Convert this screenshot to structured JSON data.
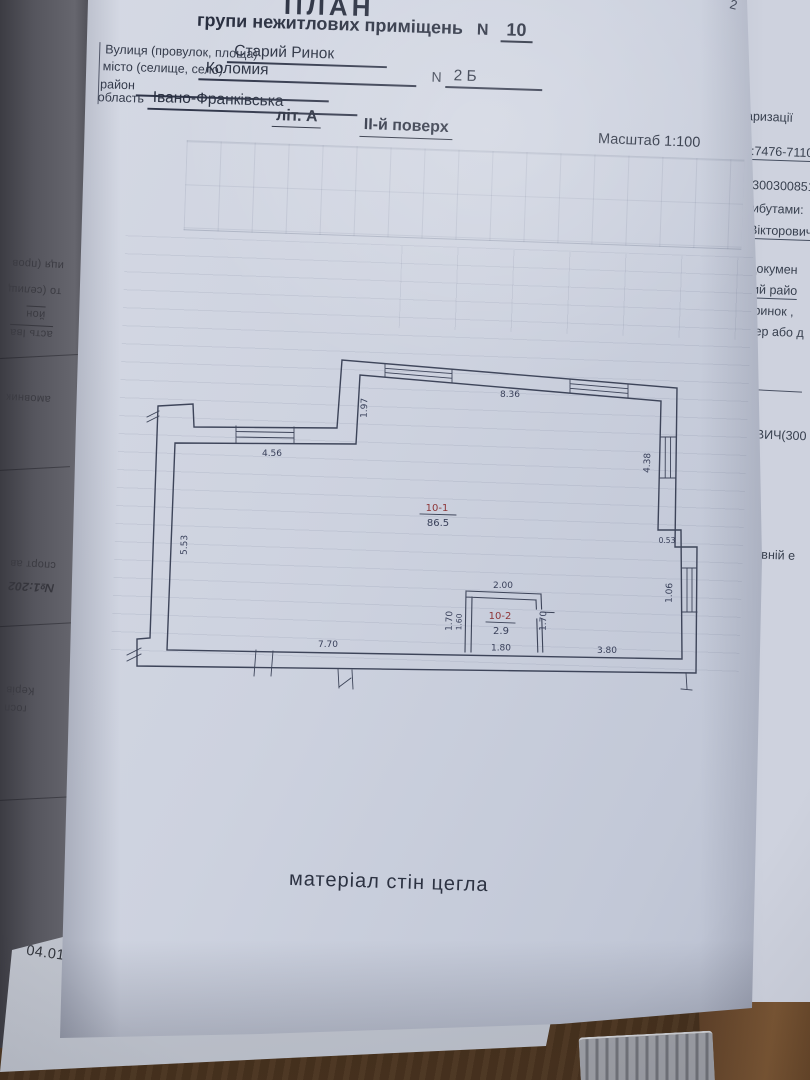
{
  "page": {
    "corner_number": "2",
    "header": {
      "title": "ПЛАН",
      "subtitle": "групи нежитлових приміщень",
      "number_label": "N",
      "premises_number": "10",
      "street_label": "Вулиця (провулок, площа)",
      "street_value": "Старий Ринок",
      "city_label": "місто (селище, село)",
      "city_value": "Коломия",
      "house_label": "N",
      "house_value": "2 Б",
      "district_label": "район",
      "region_label": "область",
      "region_value": "Івано-Франківська",
      "letter": "літ. А",
      "floor": "ІІ-й поверх",
      "scale": "Масштаб 1:100"
    },
    "plan": {
      "rooms": [
        {
          "number": "10-1",
          "area": "86.5"
        },
        {
          "number": "10-2",
          "area": "2.9"
        }
      ],
      "dims": {
        "top_wall": "8.36",
        "top_step": "1.97",
        "upper_left_wall": "4.56",
        "left_wall": "5.53",
        "right_wall_upper": "4.38",
        "right_step": "0.53",
        "right_wall_lower": "1.06",
        "closet_top": "2.00",
        "closet_left_outer": "1.70",
        "closet_left_inner": "1.60",
        "closet_right": "1.70",
        "closet_bottom": "1.80",
        "bottom_wall_left": "7.70",
        "bottom_wall_right": "3.80"
      },
      "material_note": "матеріал стін цегла"
    }
  },
  "underlying_right": {
    "fragments": [
      "аризації",
      "1:7476-7110-",
      "(300300851",
      "рибутами:",
      "Вікторович",
      "з докумен",
      "ький райо",
      "й ринок ,",
      "мер або д",
      "РОВИЧ(300",
      "жавній е"
    ]
  },
  "underlying_left": {
    "fragments": [
      "иця (пров",
      "то (селищ",
      "йон",
      "асть  Іва",
      "амовник",
      "спорт ав",
      "№1:202",
      "Керів",
      "госп"
    ]
  },
  "bottom_page": {
    "date_stamp": "04.01.2021"
  }
}
